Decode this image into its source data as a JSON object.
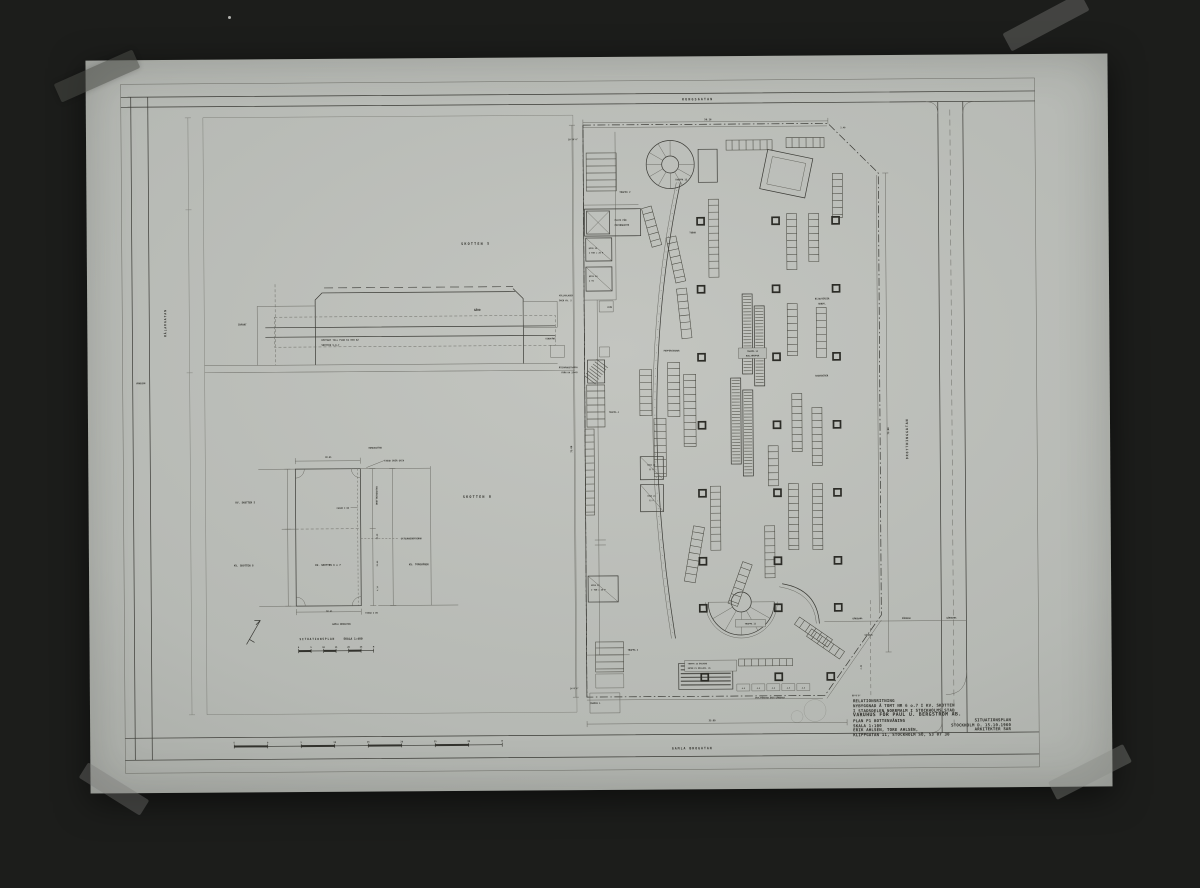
{
  "photo": {
    "background_hex": "#454843",
    "sheet_hex": "#b6b9b4",
    "ink_hex": "#2f2f2a",
    "description_type": "photograph-of-architectural-drawing"
  },
  "title_block": {
    "rows": [
      {
        "left": "RELATIONSRITNING"
      },
      {
        "left": "NYBYGGNAD Å TOMT NR 6 o.7 I KV. SKOTTEN"
      },
      {
        "left": "I STADSDELEN NORRMALM I STOCKHOLMS STAD"
      },
      {
        "left": "VARUHUS FÖR PAUL U. BERGSTRÖM AB."
      },
      {
        "left": "PLAN P1 BOTTENVÅNING",
        "right": "SITUATIONSPLAN"
      },
      {
        "left": "SKALA 1:100",
        "right": "STOCKHOLM D. 15.10.1960"
      },
      {
        "left": "ERIK AHLSÉN, TORE AHLSÉN,",
        "right": "ARKITEKTER SAR"
      },
      {
        "left": "KLIPPGATAN 11, STOCKHOLM SÖ, 53 07 30"
      }
    ]
  },
  "labels": [
    {
      "t": "KUNGSGATAN",
      "x": 612,
      "y": 44,
      "s": 3.2,
      "ls": 1.2,
      "n": "street-label-kungsgatan"
    },
    {
      "t": "GAMLA BROGATAN",
      "x": 602,
      "y": 693,
      "s": 3.2,
      "ls": 1,
      "n": "street-label-gamla-brogatan"
    },
    {
      "t": "DROTTNINGGATAN",
      "x": 820,
      "y": 384,
      "s": 3.2,
      "r": -90,
      "ls": 1,
      "n": "street-label-drottninggatan"
    },
    {
      "t": "MÅLARGATAN",
      "x": 79,
      "y": 263,
      "s": 3,
      "r": -90,
      "ls": 1,
      "n": "street-label-malargatan"
    },
    {
      "t": "VÄNDZON",
      "x": 53,
      "y": 324,
      "s": 2.2
    },
    {
      "t": "SKOTTEN 5",
      "x": 389,
      "y": 187,
      "s": 3.4,
      "ls": 1.2,
      "n": "block-label-skotten-5"
    },
    {
      "t": "SKOTTEN 8",
      "x": 389,
      "y": 440,
      "s": 3.4,
      "ls": 1.2,
      "n": "block-label-skotten-8"
    },
    {
      "t": "GÅRD",
      "x": 390,
      "y": 253,
      "s": 2.8
    },
    {
      "t": "INFART",
      "x": 155,
      "y": 266,
      "s": 2.4
    },
    {
      "t": "UPPFART TILL PLAN K1 OCH K2",
      "x": 234,
      "y": 282,
      "s": 2.3,
      "a": "start"
    },
    {
      "t": "SKOTTEN 5,6,7",
      "x": 234,
      "y": 287,
      "s": 2.3,
      "a": "start"
    },
    {
      "t": "KÄLLARLAGER",
      "x": 472,
      "y": 239,
      "s": 2.1,
      "a": "start"
    },
    {
      "t": "ÖVER KV. 5",
      "x": 472,
      "y": 244,
      "s": 2.1,
      "a": "start"
    },
    {
      "t": "VINDFÅNG",
      "x": 468,
      "y": 282,
      "s": 2.1,
      "a": "end"
    },
    {
      "t": "ÅTERVÄNDSTRAPPA",
      "x": 490,
      "y": 311,
      "s": 2.1,
      "a": "end"
    },
    {
      "t": "FRÅN KA 25×45",
      "x": 490,
      "y": 316,
      "s": 2.1,
      "a": "end"
    },
    {
      "t": "KUNGSGATAN",
      "x": 287,
      "y": 390,
      "s": 2.2
    },
    {
      "t": "FASAD ÖVER GATA",
      "x": 296,
      "y": 403,
      "s": 2.2,
      "a": "start"
    },
    {
      "t": "38.95",
      "x": 240,
      "y": 399,
      "s": 2.1
    },
    {
      "t": "KV. SKOTTEN 5",
      "x": 147,
      "y": 444,
      "s": 2.5,
      "a": "start"
    },
    {
      "t": "KV. SKOTTEN 8",
      "x": 145,
      "y": 507,
      "s": 2.5,
      "a": "start"
    },
    {
      "t": "KV. SKOTTEN 6 o 7",
      "x": 239,
      "y": 507,
      "s": 2.5
    },
    {
      "t": "FASAD I BV",
      "x": 248,
      "y": 450,
      "s": 2.1,
      "a": "start"
    },
    {
      "t": "DROTTNINGGATAN",
      "x": 289,
      "y": 437,
      "s": 2.2,
      "r": -90
    },
    {
      "t": "30.48",
      "x": 289,
      "y": 478,
      "s": 1.9,
      "r": -90
    },
    {
      "t": "21.00",
      "x": 289,
      "y": 505,
      "s": 1.9,
      "r": -90
    },
    {
      "t": "4.14",
      "x": 289,
      "y": 530,
      "s": 1.9,
      "r": -90
    },
    {
      "t": "GATUUNDERBYGGNAD",
      "x": 312,
      "y": 481,
      "s": 2.2,
      "a": "start"
    },
    {
      "t": "KV. TORGVÅGEN",
      "x": 320,
      "y": 507,
      "s": 2.5,
      "a": "start"
    },
    {
      "t": "FASAD I BV",
      "x": 276,
      "y": 555,
      "s": 2.1,
      "a": "start"
    },
    {
      "t": "58.41",
      "x": 240,
      "y": 553,
      "s": 2.1
    },
    {
      "t": "GAMLA BROGATAN",
      "x": 252,
      "y": 566,
      "s": 2.2
    },
    {
      "t": "SITUATIONSPLAN",
      "x": 210,
      "y": 581,
      "s": 2.9,
      "ls": 0.8,
      "a": "start",
      "n": "situationsplan-caption"
    },
    {
      "t": "SKALA 1:400",
      "x": 254,
      "y": 581,
      "s": 2.9,
      "a": "start",
      "n": "situationsplan-scale"
    },
    {
      "t": "56.16",
      "x": 622,
      "y": 64,
      "s": 2.4
    },
    {
      "t": "20°16'6\"",
      "x": 482,
      "y": 83,
      "s": 2.1,
      "a": "start"
    },
    {
      "t": "2.40",
      "x": 757,
      "y": 73,
      "s": 2.1
    },
    {
      "t": "TRAPPA 2",
      "x": 533,
      "y": 136,
      "s": 2.3,
      "a": "start"
    },
    {
      "t": "TRAPPA 13",
      "x": 589,
      "y": 124,
      "s": 2.2,
      "a": "start"
    },
    {
      "t": "PLATS FÖR",
      "x": 528,
      "y": 164,
      "s": 2.2,
      "a": "start"
    },
    {
      "t": "PATERNOSTER",
      "x": 528,
      "y": 169,
      "s": 2.2,
      "a": "start"
    },
    {
      "t": "HISS 23",
      "x": 502,
      "y": 192,
      "s": 2,
      "a": "start"
    },
    {
      "t": "2 TON = 25 P",
      "x": 502,
      "y": 196.5,
      "s": 2,
      "a": "start"
    },
    {
      "t": "HISS 24",
      "x": 502,
      "y": 220,
      "s": 2,
      "a": "start"
    },
    {
      "t": "2 TO",
      "x": 502,
      "y": 224.5,
      "s": 2,
      "a": "start"
    },
    {
      "t": "STÄD",
      "x": 520,
      "y": 251,
      "s": 2,
      "a": "start"
    },
    {
      "t": "TOBAK",
      "x": 606,
      "y": 177,
      "s": 2.2
    },
    {
      "t": "PAPPERSVAROR",
      "x": 584,
      "y": 295,
      "s": 2.2
    },
    {
      "t": "BIJOUTERIER",
      "x": 735,
      "y": 244,
      "s": 2.2
    },
    {
      "t": "HANDV.",
      "x": 735,
      "y": 249,
      "s": 2.2
    },
    {
      "t": "SOUVENIRER",
      "x": 734,
      "y": 321,
      "s": 2.2
    },
    {
      "t": "TRAPPA 14",
      "x": 665,
      "y": 296,
      "s": 2
    },
    {
      "t": "RULLTRAPPOR",
      "x": 665,
      "y": 300.5,
      "s": 2
    },
    {
      "t": "TRAPPA 4",
      "x": 521,
      "y": 356,
      "s": 2.1,
      "a": "start"
    },
    {
      "t": "HISS 19",
      "x": 563,
      "y": 409,
      "s": 1.9
    },
    {
      "t": "12 P",
      "x": 563,
      "y": 413.5,
      "s": 1.9
    },
    {
      "t": "HISS 21",
      "x": 563,
      "y": 440,
      "s": 1.9
    },
    {
      "t": "12 P",
      "x": 563,
      "y": 444.5,
      "s": 1.9
    },
    {
      "t": "73.00",
      "x": 484,
      "y": 392,
      "s": 2.3,
      "r": -90
    },
    {
      "t": "75.00",
      "x": 801,
      "y": 376,
      "s": 2.3,
      "r": -90
    },
    {
      "t": "HISS 22",
      "x": 502,
      "y": 529,
      "s": 2,
      "a": "start"
    },
    {
      "t": "2 TON = 25 P",
      "x": 502,
      "y": 533.5,
      "s": 2,
      "a": "start"
    },
    {
      "t": "TRAPPA 3",
      "x": 538,
      "y": 594,
      "s": 2.2,
      "a": "start"
    },
    {
      "t": "TRAPPA 1",
      "x": 500,
      "y": 647,
      "s": 2.2,
      "a": "start"
    },
    {
      "t": "TRAPPA 12",
      "x": 661,
      "y": 568.5,
      "s": 2.1
    },
    {
      "t": "TRAPPA 10 BALKONG",
      "x": 598,
      "y": 608,
      "s": 1.9,
      "a": "start"
    },
    {
      "t": "ENTRÉ P1 MELLANV. 45",
      "x": 598,
      "y": 612.5,
      "s": 1.9,
      "a": "start"
    },
    {
      "t": "4.5",
      "x": 653.5,
      "y": 633,
      "s": 1.8
    },
    {
      "t": "4.5",
      "x": 668.5,
      "y": 633,
      "s": 1.8
    },
    {
      "t": "4.5",
      "x": 683.5,
      "y": 633,
      "s": 1.8
    },
    {
      "t": "4.5",
      "x": 698.5,
      "y": 633,
      "s": 1.8
    },
    {
      "t": "4.5",
      "x": 713.5,
      "y": 633,
      "s": 1.8
    },
    {
      "t": "SKYLTFÖNSTER ÖVER GÅNGBANA",
      "x": 680,
      "y": 642.5,
      "s": 1.9
    },
    {
      "t": "14°0'6\"",
      "x": 480,
      "y": 632,
      "s": 2.1,
      "a": "start"
    },
    {
      "t": "60°0'0\"",
      "x": 762,
      "y": 641,
      "s": 2.1,
      "a": "start"
    },
    {
      "t": "4.50",
      "x": 772,
      "y": 612,
      "s": 1.9,
      "r": -90
    },
    {
      "t": "GÅNGBANA",
      "x": 768,
      "y": 564,
      "s": 2.1
    },
    {
      "t": "KÖRBANA",
      "x": 817,
      "y": 564,
      "s": 2.1
    },
    {
      "t": "GÅNGBANA",
      "x": 862,
      "y": 564,
      "s": 2.1
    },
    {
      "t": "VÄNDZON",
      "x": 779,
      "y": 580.5,
      "s": 1.9
    },
    {
      "t": "35.00",
      "x": 622,
      "y": 665,
      "s": 2.3
    }
  ],
  "columns": {
    "size": 7,
    "xs": [
      614,
      689,
      749
    ],
    "ys": [
      165,
      233,
      301,
      369,
      437,
      505,
      552
    ],
    "extra": [
      [
        615,
        621
      ],
      [
        689,
        621
      ],
      [
        741,
        621
      ]
    ]
  },
  "fixtures": [
    {
      "x": 500,
      "y": 96,
      "w": 30,
      "h": 38
    },
    {
      "x": 506,
      "y": 585,
      "w": 28,
      "h": 30
    },
    {
      "x": 499,
      "y": 328,
      "w": 18,
      "h": 42
    },
    {
      "x": 497,
      "y": 372,
      "w": 9,
      "h": 86
    },
    {
      "x": 580,
      "y": 306,
      "w": 12,
      "h": 54
    },
    {
      "x": 596,
      "y": 318,
      "w": 12,
      "h": 72
    },
    {
      "x": 566,
      "y": 362,
      "w": 12,
      "h": 58
    },
    {
      "x": 552,
      "y": 313,
      "w": 12,
      "h": 46
    },
    {
      "x": 622,
      "y": 143,
      "w": 10,
      "h": 78
    },
    {
      "x": 640,
      "y": 84,
      "w": 46,
      "h": 10
    },
    {
      "x": 700,
      "y": 82,
      "w": 38,
      "h": 10
    },
    {
      "x": 700,
      "y": 158,
      "w": 10,
      "h": 56
    },
    {
      "x": 722,
      "y": 158,
      "w": 10,
      "h": 48
    },
    {
      "x": 700,
      "y": 248,
      "w": 10,
      "h": 52
    },
    {
      "x": 729,
      "y": 252,
      "w": 10,
      "h": 50
    },
    {
      "x": 704,
      "y": 338,
      "w": 10,
      "h": 58
    },
    {
      "x": 724,
      "y": 352,
      "w": 10,
      "h": 58
    },
    {
      "x": 700,
      "y": 428,
      "w": 10,
      "h": 66
    },
    {
      "x": 724,
      "y": 428,
      "w": 10,
      "h": 66
    },
    {
      "x": 622,
      "y": 430,
      "w": 10,
      "h": 64
    },
    {
      "x": 600,
      "y": 470,
      "w": 11,
      "h": 56,
      "r": 10
    },
    {
      "x": 646,
      "y": 506,
      "w": 10,
      "h": 44,
      "r": 20
    },
    {
      "x": 676,
      "y": 470,
      "w": 10,
      "h": 52
    },
    {
      "x": 649,
      "y": 603,
      "w": 54,
      "h": 7
    },
    {
      "x": 704,
      "y": 572,
      "w": 40,
      "h": 9,
      "r": 35
    },
    {
      "x": 716,
      "y": 584,
      "w": 40,
      "h": 9,
      "r": 35
    },
    {
      "x": 584,
      "y": 180,
      "w": 10,
      "h": 46,
      "r": -12
    },
    {
      "x": 592,
      "y": 232,
      "w": 10,
      "h": 50,
      "r": -6
    },
    {
      "x": 746,
      "y": 118,
      "w": 10,
      "h": 44
    },
    {
      "x": 680,
      "y": 390,
      "w": 10,
      "h": 40
    },
    {
      "x": 560,
      "y": 150,
      "w": 10,
      "h": 40,
      "r": -15
    }
  ],
  "scalebars": [
    {
      "x": 144,
      "y": 687,
      "seg": 33.5,
      "labels": [
        "5",
        "0",
        "5",
        "10",
        "15",
        "20",
        "25",
        "30",
        "M"
      ]
    },
    {
      "x": 209,
      "y": 592,
      "seg": 12.5,
      "labels": [
        "0",
        "5",
        "10",
        "15",
        "20",
        "25",
        "M"
      ]
    }
  ]
}
